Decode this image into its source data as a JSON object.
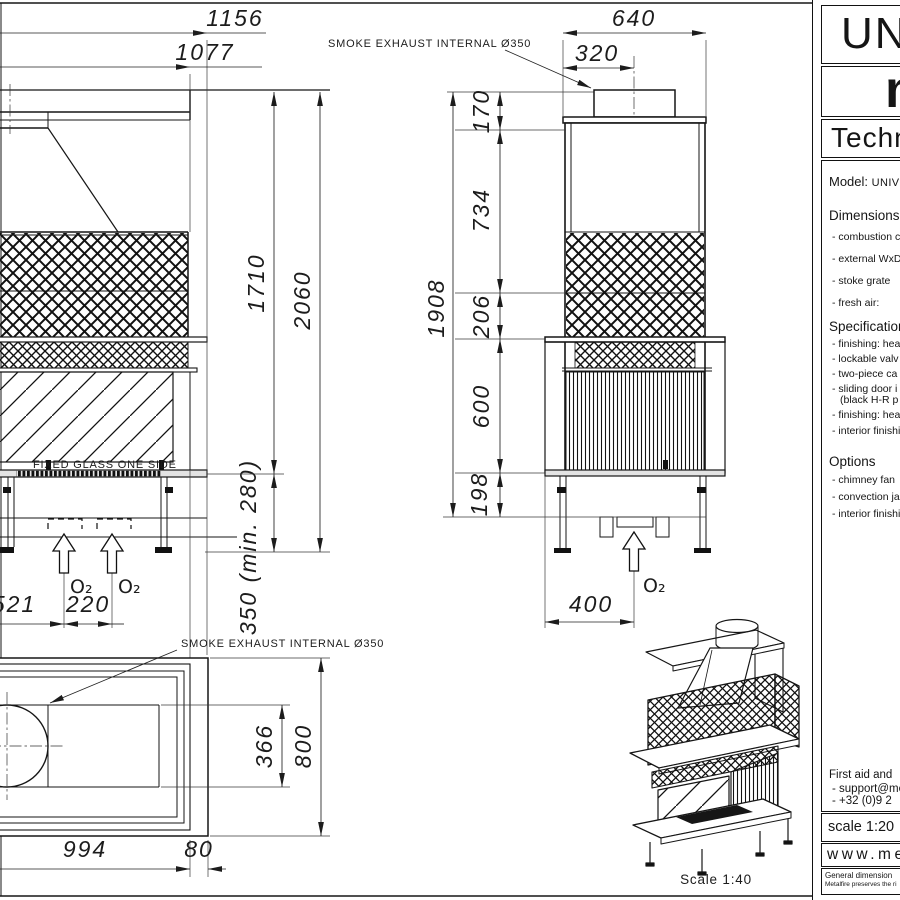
{
  "sheet": {
    "line_color": "#1a1a1a",
    "background": "#ffffff"
  },
  "annotations": {
    "smoke_exhaust_side": "SMOKE EXHAUST INTERNAL Ø350",
    "smoke_exhaust_plan": "SMOKE EXHAUST INTERNAL Ø350",
    "fixed_glass": "FIXED GLASS ONE SIDE",
    "o2": "O₂",
    "iso_scale": "Scale 1:40"
  },
  "front_view": {
    "dims": {
      "total_width": "1156",
      "body_width": "1077",
      "height_upper": "1710",
      "height_total": "2060",
      "floor_clearance": "350 (min. 280)",
      "left_offset": "521",
      "o2_spacing": "220"
    }
  },
  "side_view": {
    "dims": {
      "depth_total": "640",
      "flue_offset": "320",
      "collar_height": "170",
      "hood_height": "734",
      "height_total": "1908",
      "mesh_band": "206",
      "firebox_height": "600",
      "base_height": "198",
      "o2_offset": "400"
    }
  },
  "top_view": {
    "dims": {
      "opening_depth": "366",
      "depth_total": "800",
      "body_width": "994",
      "frame_width": "80"
    }
  },
  "title_block": {
    "product_line": "UNIV",
    "brand": "m",
    "doc_type": "Techn",
    "model_label": "Model:",
    "model_value": "UNIV",
    "dimensions_title": "Dimensions",
    "dimensions_items": [
      "- combustion c",
      "- external WxD",
      "- stoke grate",
      "- fresh air:"
    ],
    "specification_title": "Specification",
    "specification_items": [
      "- finishing: hea",
      "- lockable valv",
      "- two-piece ca",
      "- sliding door i",
      "(black H-R p",
      "- finishing: hea",
      "- interior finishi"
    ],
    "options_title": "Options",
    "options_items": [
      "- chimney fan",
      "- convection ja",
      "- interior finishi"
    ],
    "contact_lines": [
      "First aid and",
      "- support@me",
      "- +32 (0)9 2"
    ],
    "scale_text": "scale 1:20",
    "website": "www.met",
    "fineprint_1": "General dimension",
    "fineprint_2": "Metalfire preserves the ri"
  }
}
